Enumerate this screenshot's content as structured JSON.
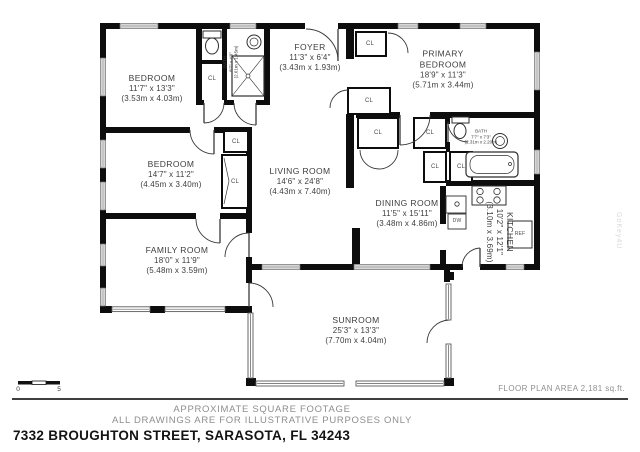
{
  "rooms": {
    "bedroom1": {
      "name": "BEDROOM",
      "dims": "11'7\" x 13'3\"",
      "metric": "(3.53m x 4.03m)"
    },
    "bedroom2": {
      "name": "BEDROOM",
      "dims": "14'7\" x 11'2\"",
      "metric": "(4.45m x 3.40m)"
    },
    "family_room": {
      "name": "FAMILY ROOM",
      "dims": "18'0\" x 11'9\"",
      "metric": "(5.48m x 3.59m)"
    },
    "foyer": {
      "name": "FOYER",
      "dims": "11'3\" x 6'4\"",
      "metric": "(3.43m x 1.93m)"
    },
    "primary_bedroom": {
      "name_line1": "PRIMARY",
      "name_line2": "BEDROOM",
      "dims": "18'9\" x 11'3\"",
      "metric": "(5.71m x 3.44m)"
    },
    "living_room": {
      "name": "LIVING ROOM",
      "dims": "14'6\" x 24'8\"",
      "metric": "(4.43m x 7.40m)"
    },
    "dining_room": {
      "name": "DINING ROOM",
      "dims": "11'5\" x 15'11\"",
      "metric": "(3.48m x 4.86m)"
    },
    "kitchen": {
      "name": "KITCHEN",
      "dims": "10'2\" x 12'1\"",
      "metric": "(3.10m x 3.69m)"
    },
    "sunroom": {
      "name": "SUNROOM",
      "dims": "25'3\" x 13'3\"",
      "metric": "(7.70m x 4.04m)"
    },
    "bath1": {
      "name": "BATH",
      "dims": "8'7\" x 4'9\"",
      "metric": "(2.61m x 1.45m)"
    },
    "bath2": {
      "name": "BATH",
      "dims": "7'7\" x 7'3\"",
      "metric": "(2.31m x 2.20m)"
    }
  },
  "labels": {
    "closet": "CL",
    "dishwasher": "DW",
    "refrigerator": "REF"
  },
  "scale_bar": {
    "start": "0",
    "end": "5"
  },
  "footer": {
    "area_note": "FLOOR PLAN AREA 2,181 sq.ft.",
    "disclaimer_line1": "APPROXIMATE SQUARE FOOTAGE",
    "disclaimer_line2": "ALL DRAWINGS ARE FOR ILLUSTRATIVE PURPOSES ONLY",
    "address": "7332 BROUGHTON STREET, SARASOTA, FL 34243"
  },
  "watermark": "GoKey4U"
}
